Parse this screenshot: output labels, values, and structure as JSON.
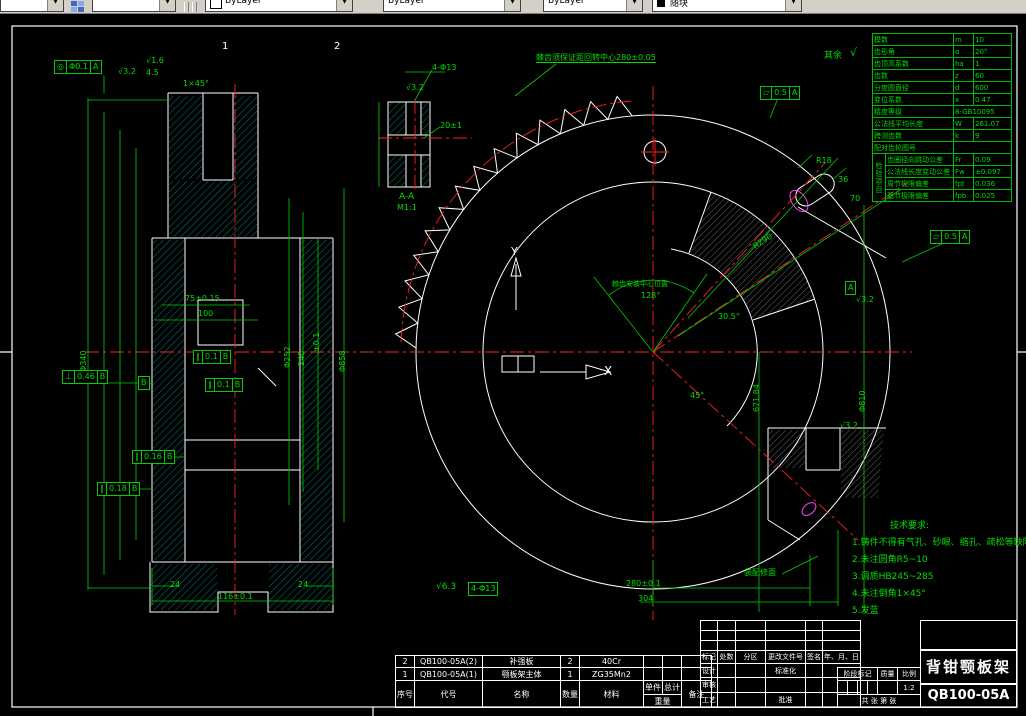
{
  "toolbar": {
    "combos": [
      {
        "label": ""
      },
      {
        "label": ""
      },
      {
        "label": "ByLayer"
      },
      {
        "label": "ByLayer"
      },
      {
        "label": "ByLayer"
      },
      {
        "label": "随块"
      }
    ]
  },
  "gear_table": {
    "side_label": "检验项目",
    "rows": [
      {
        "name": "模数",
        "sym": "m",
        "val": "10"
      },
      {
        "name": "齿形角",
        "sym": "α",
        "val": "20°"
      },
      {
        "name": "齿顶高系数",
        "sym": "ha",
        "val": "1"
      },
      {
        "name": "齿数",
        "sym": "z",
        "val": "60"
      },
      {
        "name": "分度圆直径",
        "sym": "d",
        "val": "600"
      },
      {
        "name": "变位系数",
        "sym": "x",
        "val": "0.47"
      },
      {
        "name": "精度等级",
        "sym": "",
        "val": "8-GB10095"
      },
      {
        "name": "公法线平均长度",
        "sym": "W",
        "val": "261.07"
      },
      {
        "name": "跨测齿数",
        "sym": "k",
        "val": "9"
      },
      {
        "name": "配对齿轮图号",
        "sym": "",
        "val": ""
      },
      {
        "name": "齿圈径向跳动公差",
        "sym": "Fr",
        "val": "0.09"
      },
      {
        "name": "公法线长度变动公差",
        "sym": "Fw",
        "val": "±0.097"
      },
      {
        "name": "周节极限偏差",
        "sym": "fpt",
        "val": "0.036"
      },
      {
        "name": "基节极限偏差",
        "sym": "fpb",
        "val": "0.025"
      }
    ]
  },
  "tech_notes": {
    "title": "技术要求:",
    "lines": [
      "1.铸件不得有气孔、砂眼、缩孔、疏松等缺陷",
      "2.未注圆角R5~10",
      "3.调质HB245~285",
      "4.未注倒角1×45°",
      "5.发蓝"
    ]
  },
  "bom": {
    "headers": {
      "no": "序号",
      "code": "代号",
      "name": "名称",
      "qty": "数量",
      "material": "材料",
      "single": "单件",
      "total": "总计",
      "weight": "重量",
      "remark": "备注"
    },
    "rows": [
      {
        "no": "2",
        "code": "QB100-05A(2)",
        "name": "补强板",
        "qty": "2",
        "material": "40Cr"
      },
      {
        "no": "1",
        "code": "QB100-05A(1)",
        "name": "颚板架主体",
        "qty": "1",
        "material": "ZG35Mn2"
      }
    ]
  },
  "title_block": {
    "header_row": [
      "标记",
      "处数",
      "分区",
      "更改文件号",
      "签名",
      "年、月、日"
    ],
    "design": "设计",
    "standard": "标准化",
    "check": "审核",
    "process": "工艺",
    "approve": "批准",
    "stage": "阶段标记",
    "quality": "质量",
    "scale_label": "比例",
    "scale": "1:2",
    "sheets": "共 张 第 张",
    "title": "背钳颚板架",
    "drawing_no": "QB100-05A"
  },
  "colors": {
    "green": "#00dd00",
    "white": "#ffffff",
    "red": "#ff2020",
    "magenta": "#ff40ff",
    "cyan": "#00cccc"
  },
  "annotations": [
    {
      "t": "4.5",
      "x": 146,
      "y": 69,
      "c": "g",
      "s": 8
    },
    {
      "t": "1×45°",
      "x": 183,
      "y": 80,
      "c": "g",
      "s": 8
    },
    {
      "t": "√3.2",
      "x": 118,
      "y": 68,
      "c": "g",
      "s": 8
    },
    {
      "t": "√1.6",
      "x": 146,
      "y": 57,
      "c": "g",
      "s": 8
    },
    {
      "t": "75±0.15",
      "x": 185,
      "y": 295,
      "c": "g",
      "s": 8
    },
    {
      "t": "100",
      "x": 198,
      "y": 310,
      "c": "g",
      "s": 8
    },
    {
      "t": "116±0.1",
      "x": 218,
      "y": 593,
      "c": "g",
      "s": 8
    },
    {
      "t": "24",
      "x": 170,
      "y": 581,
      "c": "g",
      "s": 8
    },
    {
      "t": "24",
      "x": 298,
      "y": 581,
      "c": "g",
      "s": 8
    },
    {
      "t": "Φ340",
      "x": 80,
      "y": 372,
      "c": "g",
      "s": 8,
      "r": -90
    },
    {
      "t": "Φ252",
      "x": 284,
      "y": 368,
      "c": "g",
      "s": 8,
      "r": -90
    },
    {
      "t": "240",
      "x": 298,
      "y": 366,
      "c": "g",
      "s": 8,
      "r": -90
    },
    {
      "t": "±0.1",
      "x": 313,
      "y": 352,
      "c": "g",
      "s": 8,
      "r": -90
    },
    {
      "t": "Φ858",
      "x": 339,
      "y": 372,
      "c": "g",
      "s": 8,
      "r": -90
    },
    {
      "t": "1",
      "x": 222,
      "y": 42,
      "c": "w",
      "s": 10
    },
    {
      "t": "2",
      "x": 334,
      "y": 42,
      "c": "w",
      "s": 10
    },
    {
      "t": "4-Φ13",
      "x": 432,
      "y": 64,
      "c": "g",
      "s": 8
    },
    {
      "t": "√3.2",
      "x": 406,
      "y": 84,
      "c": "g",
      "s": 8
    },
    {
      "t": "20±1",
      "x": 440,
      "y": 122,
      "c": "g",
      "s": 8
    },
    {
      "t": "A-A",
      "x": 399,
      "y": 193,
      "c": "g",
      "s": 9
    },
    {
      "t": "M1:1",
      "x": 397,
      "y": 204,
      "c": "g",
      "s": 8
    },
    {
      "t": "Y",
      "x": 511,
      "y": 246,
      "c": "w",
      "s": 11
    },
    {
      "t": "X",
      "x": 604,
      "y": 365,
      "c": "w",
      "s": 12
    },
    {
      "t": "棘齿须保证距回转中心280±0.05",
      "x": 536,
      "y": 54,
      "c": "g",
      "s": 8,
      "u": 1
    },
    {
      "t": "其余",
      "x": 824,
      "y": 52,
      "c": "g",
      "s": 9
    },
    {
      "t": "√",
      "x": 850,
      "y": 47,
      "c": "g",
      "s": 11
    },
    {
      "t": "棘齿安装中心位置",
      "x": 612,
      "y": 281,
      "c": "g",
      "s": 7
    },
    {
      "t": "128°",
      "x": 641,
      "y": 292,
      "c": "g",
      "s": 8
    },
    {
      "t": "30.5°",
      "x": 718,
      "y": 313,
      "c": "g",
      "s": 8
    },
    {
      "t": "45°",
      "x": 690,
      "y": 392,
      "c": "g",
      "s": 8
    },
    {
      "t": "R290",
      "x": 752,
      "y": 244,
      "c": "g",
      "s": 8,
      "r": -33
    },
    {
      "t": "671.84",
      "x": 753,
      "y": 412,
      "c": "g",
      "s": 8,
      "r": -90
    },
    {
      "t": "Φ810",
      "x": 859,
      "y": 412,
      "c": "g",
      "s": 8,
      "r": -90
    },
    {
      "t": "280±0.1",
      "x": 626,
      "y": 580,
      "c": "g",
      "s": 8
    },
    {
      "t": "304",
      "x": 638,
      "y": 595,
      "c": "g",
      "s": 8
    },
    {
      "t": "装配修面",
      "x": 744,
      "y": 569,
      "c": "g",
      "s": 8
    },
    {
      "t": "R18",
      "x": 816,
      "y": 157,
      "c": "g",
      "s": 8
    },
    {
      "t": "36",
      "x": 838,
      "y": 176,
      "c": "g",
      "s": 8
    },
    {
      "t": "70",
      "x": 850,
      "y": 195,
      "c": "g",
      "s": 8
    },
    {
      "t": "√3.2",
      "x": 840,
      "y": 422,
      "c": "g",
      "s": 8
    },
    {
      "t": "√3.2",
      "x": 856,
      "y": 296,
      "c": "g",
      "s": 8
    },
    {
      "t": "√6.3",
      "x": 436,
      "y": 583,
      "c": "g",
      "s": 9
    }
  ],
  "frames": [
    {
      "x": 54,
      "y": 60,
      "cells": [
        "◎",
        "Φ0.1",
        "A"
      ]
    },
    {
      "x": 193,
      "y": 350,
      "cells": [
        "∥",
        "0.1",
        "B"
      ]
    },
    {
      "x": 205,
      "y": 378,
      "cells": [
        "∥",
        "0.1",
        "B"
      ]
    },
    {
      "x": 62,
      "y": 370,
      "cells": [
        "⊥",
        "0.46",
        "B"
      ]
    },
    {
      "x": 132,
      "y": 450,
      "cells": [
        "∥",
        "0.16",
        "B"
      ]
    },
    {
      "x": 97,
      "y": 482,
      "cells": [
        "∥",
        "0.18",
        "B"
      ]
    },
    {
      "x": 760,
      "y": 86,
      "cells": [
        "▱",
        "0.5",
        "A"
      ]
    },
    {
      "x": 930,
      "y": 230,
      "cells": [
        "▱",
        "0.5",
        "A"
      ]
    },
    {
      "x": 138,
      "y": 376,
      "cells": [
        "B"
      ]
    },
    {
      "x": 845,
      "y": 281,
      "cells": [
        "A"
      ]
    },
    {
      "x": 468,
      "y": 582,
      "cells": [
        "4-Φ13"
      ]
    }
  ]
}
